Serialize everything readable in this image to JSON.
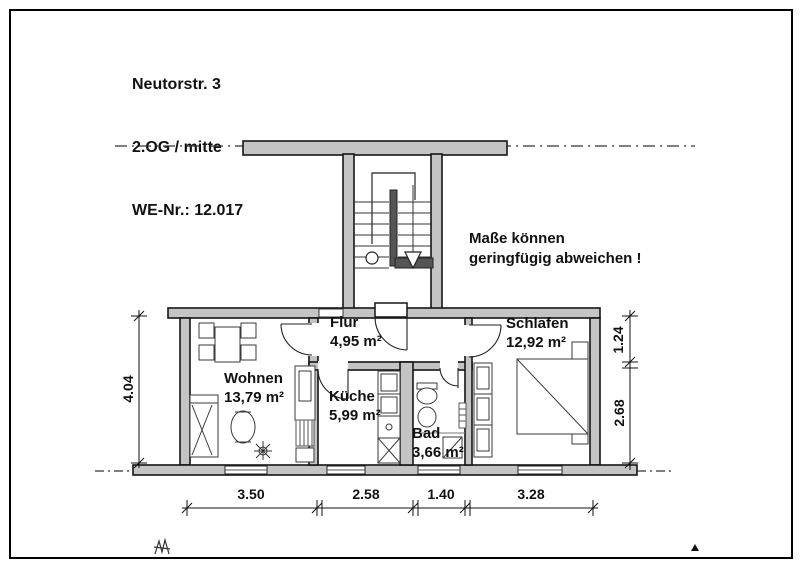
{
  "title_block": {
    "address": "Neutorstr. 3",
    "floor": "2.OG / mitte",
    "unit": "WE-Nr.: 12.017"
  },
  "note": {
    "line1": "Maße können",
    "line2": "geringfügig abweichen !"
  },
  "rooms": [
    {
      "id": "flur",
      "name": "Flur",
      "area": "4,95 m²"
    },
    {
      "id": "schlafen",
      "name": "Schlafen",
      "area": "12,92 m²"
    },
    {
      "id": "wohnen",
      "name": "Wohnen",
      "area": "13,79 m²"
    },
    {
      "id": "kueche",
      "name": "Küche",
      "area": "5,99 m²"
    },
    {
      "id": "bad",
      "name": "Bad",
      "area": "3,66 m²"
    }
  ],
  "dimensions": {
    "bottom": [
      "3.50",
      "2.58",
      "1.40",
      "3.28"
    ],
    "left": [
      "4.04"
    ],
    "right_top": "1.24",
    "right_bottom": "2.68"
  },
  "colors": {
    "wall_fill": "#c4c4c4",
    "line": "#1a1a1a",
    "background": "#ffffff"
  }
}
